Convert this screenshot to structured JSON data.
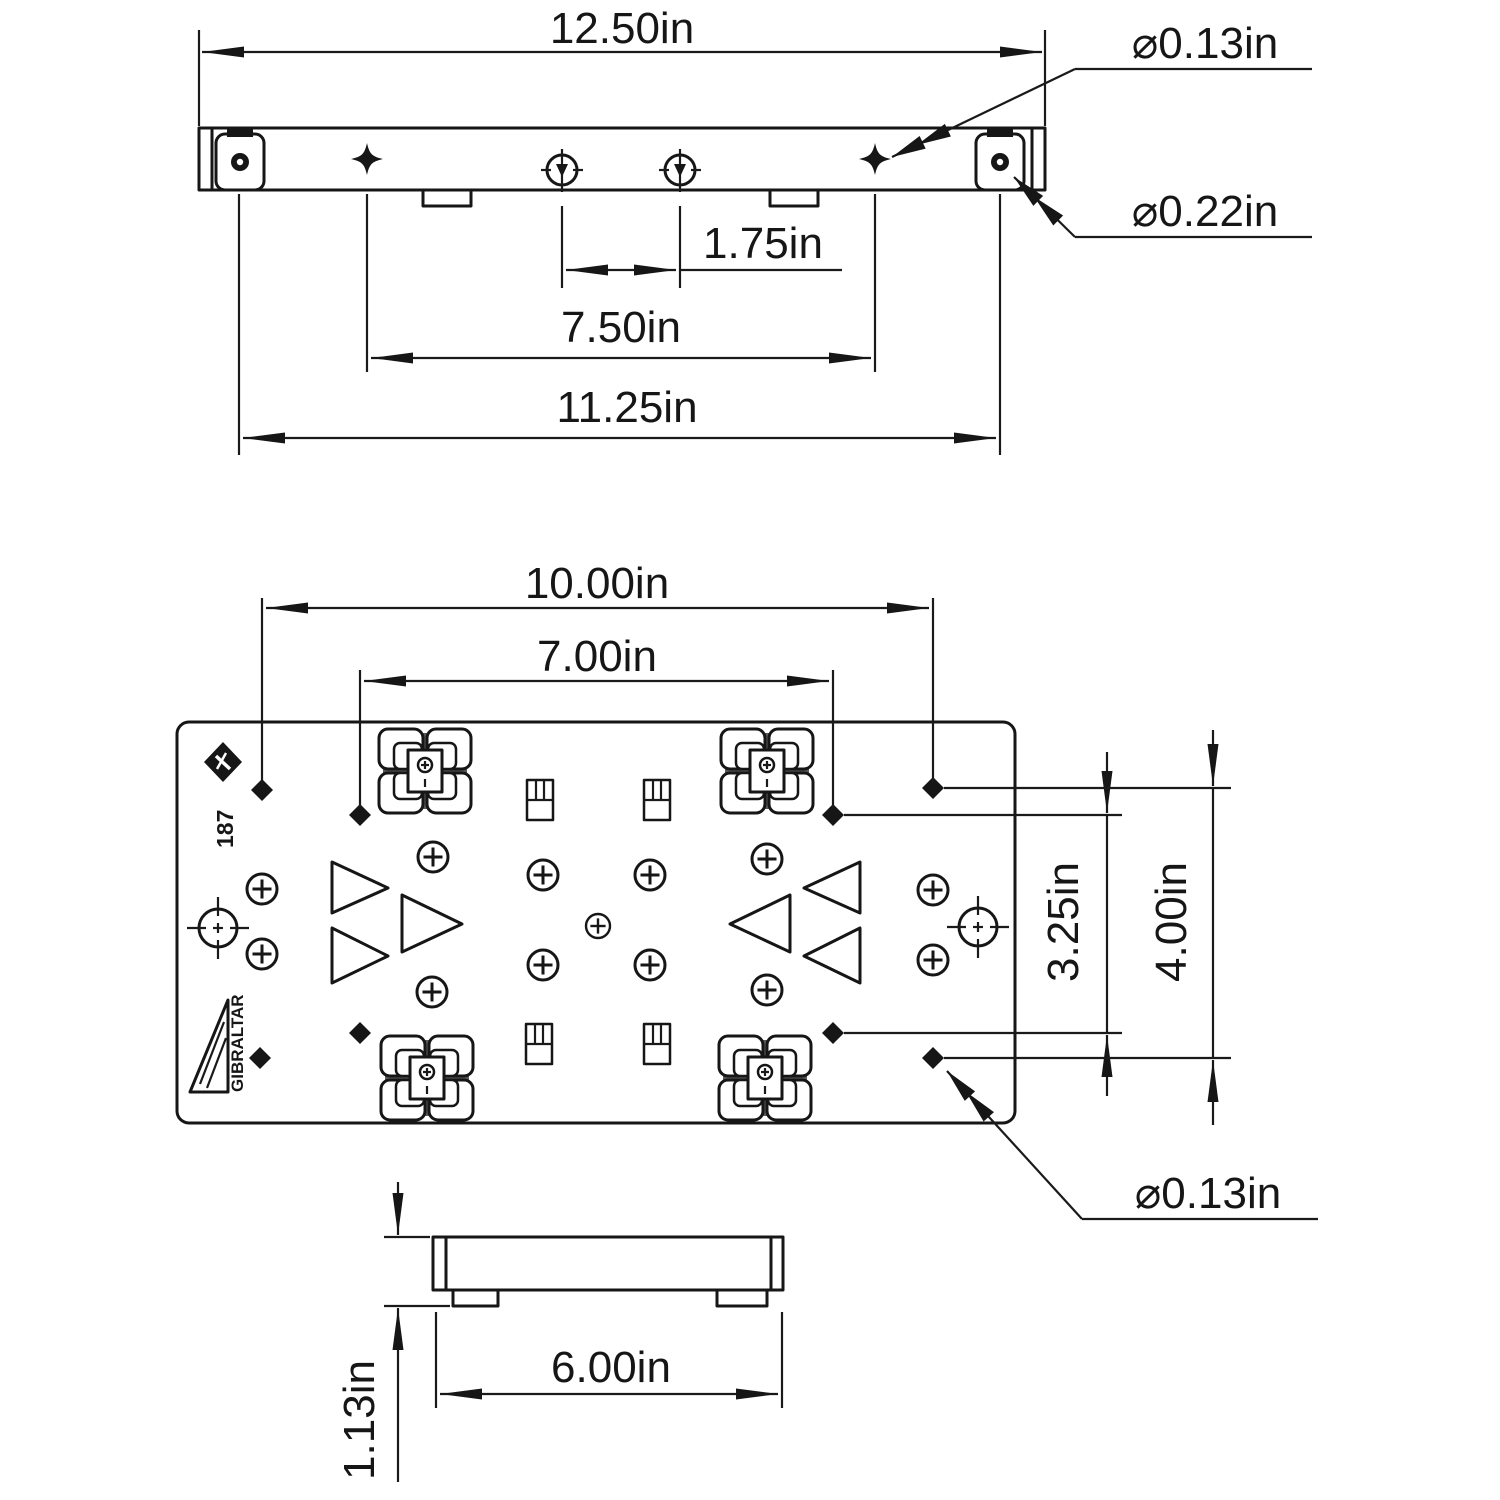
{
  "drawing": {
    "kind": "engineering-dimension-drawing",
    "units": "in",
    "line_color": "#161616",
    "background": "#ffffff",
    "top_view": {
      "dims": {
        "overall_width": "12.50in",
        "slot_spacing": "1.75in",
        "mid_hole_spacing": "7.50in",
        "end_hole_spacing": "11.25in",
        "small_hole_dia": "⌀0.13in",
        "corner_hole_dia": "⌀0.22in"
      }
    },
    "front_view": {
      "dims": {
        "outer_hole_spacing_x": "10.00in",
        "inner_hole_spacing_x": "7.00in",
        "inner_hole_spacing_y": "3.25in",
        "outer_hole_spacing_y": "4.00in",
        "hole_dia": "⌀0.13in"
      },
      "markings": {
        "part_number": "187",
        "brand": "GIBRALTAR"
      }
    },
    "side_view": {
      "dims": {
        "base_width": "6.00in",
        "height": "1.13in"
      }
    }
  }
}
